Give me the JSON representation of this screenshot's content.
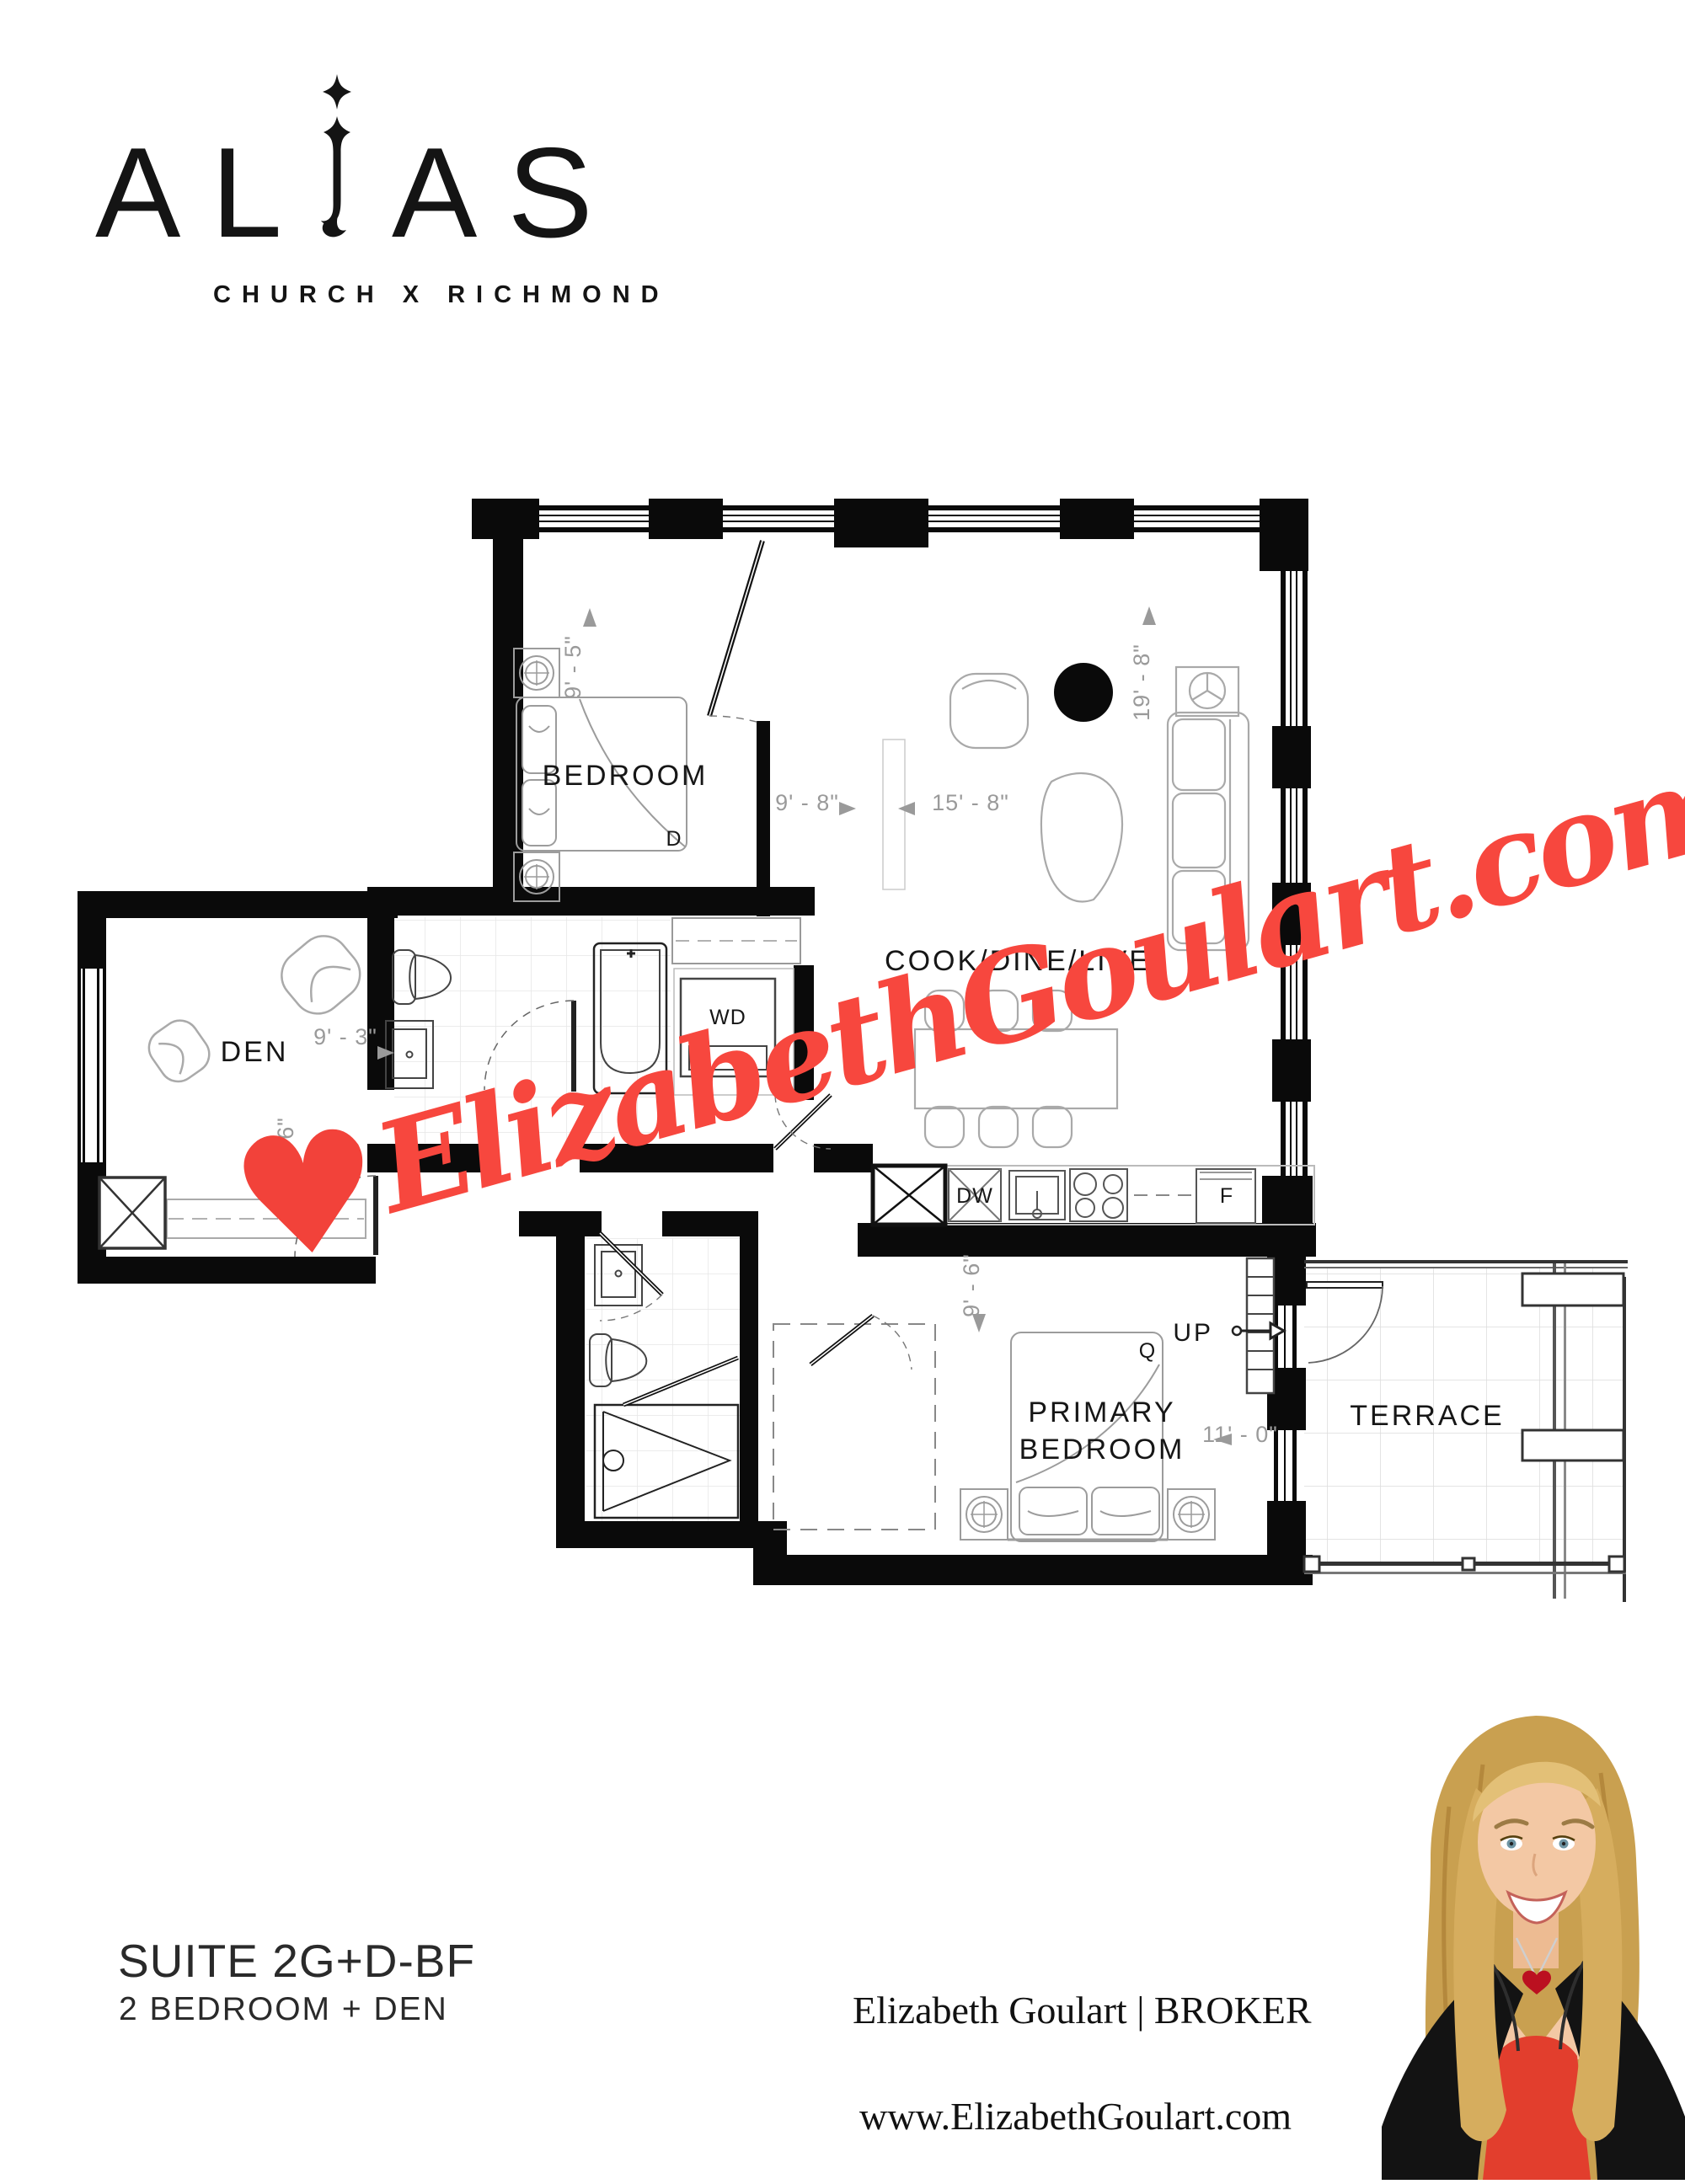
{
  "logo": {
    "l1": "A",
    "l2": "L",
    "l4": "A",
    "l5": "S",
    "word": "ALIAS",
    "tagline": "CHURCH X RICHMOND"
  },
  "plan": {
    "labels": {
      "bedroom": "BEDROOM",
      "living": "COOK/DINE/LIVE",
      "den": "DEN",
      "primary1": "PRIMARY",
      "primary2": "BEDROOM",
      "terrace": "TERRACE",
      "wd": "WD",
      "dw": "DW",
      "fridge": "F",
      "up": "UP",
      "queen": "Q",
      "double": "D"
    },
    "dims": {
      "bedroom_depth": "9' - 5\"",
      "bedroom_width": "9' - 8\"",
      "living_width": "15' - 8\"",
      "living_depth": "19' - 8\"",
      "den_width": "9' - 3\"",
      "den_depth": "8' - 6\"",
      "primary_depth": "9' - 6\"",
      "primary_width": "11' - 0\""
    }
  },
  "watermark": {
    "site": "ElizabethGoulart.com",
    "heart": "♥",
    "color": "#f7473e"
  },
  "footer": {
    "suite_code": "SUITE 2G+D-BF",
    "suite_type": "2 BEDROOM + DEN",
    "agent": "Elizabeth Goulart | BROKER",
    "website": "www.ElizabethGoulart.com"
  }
}
